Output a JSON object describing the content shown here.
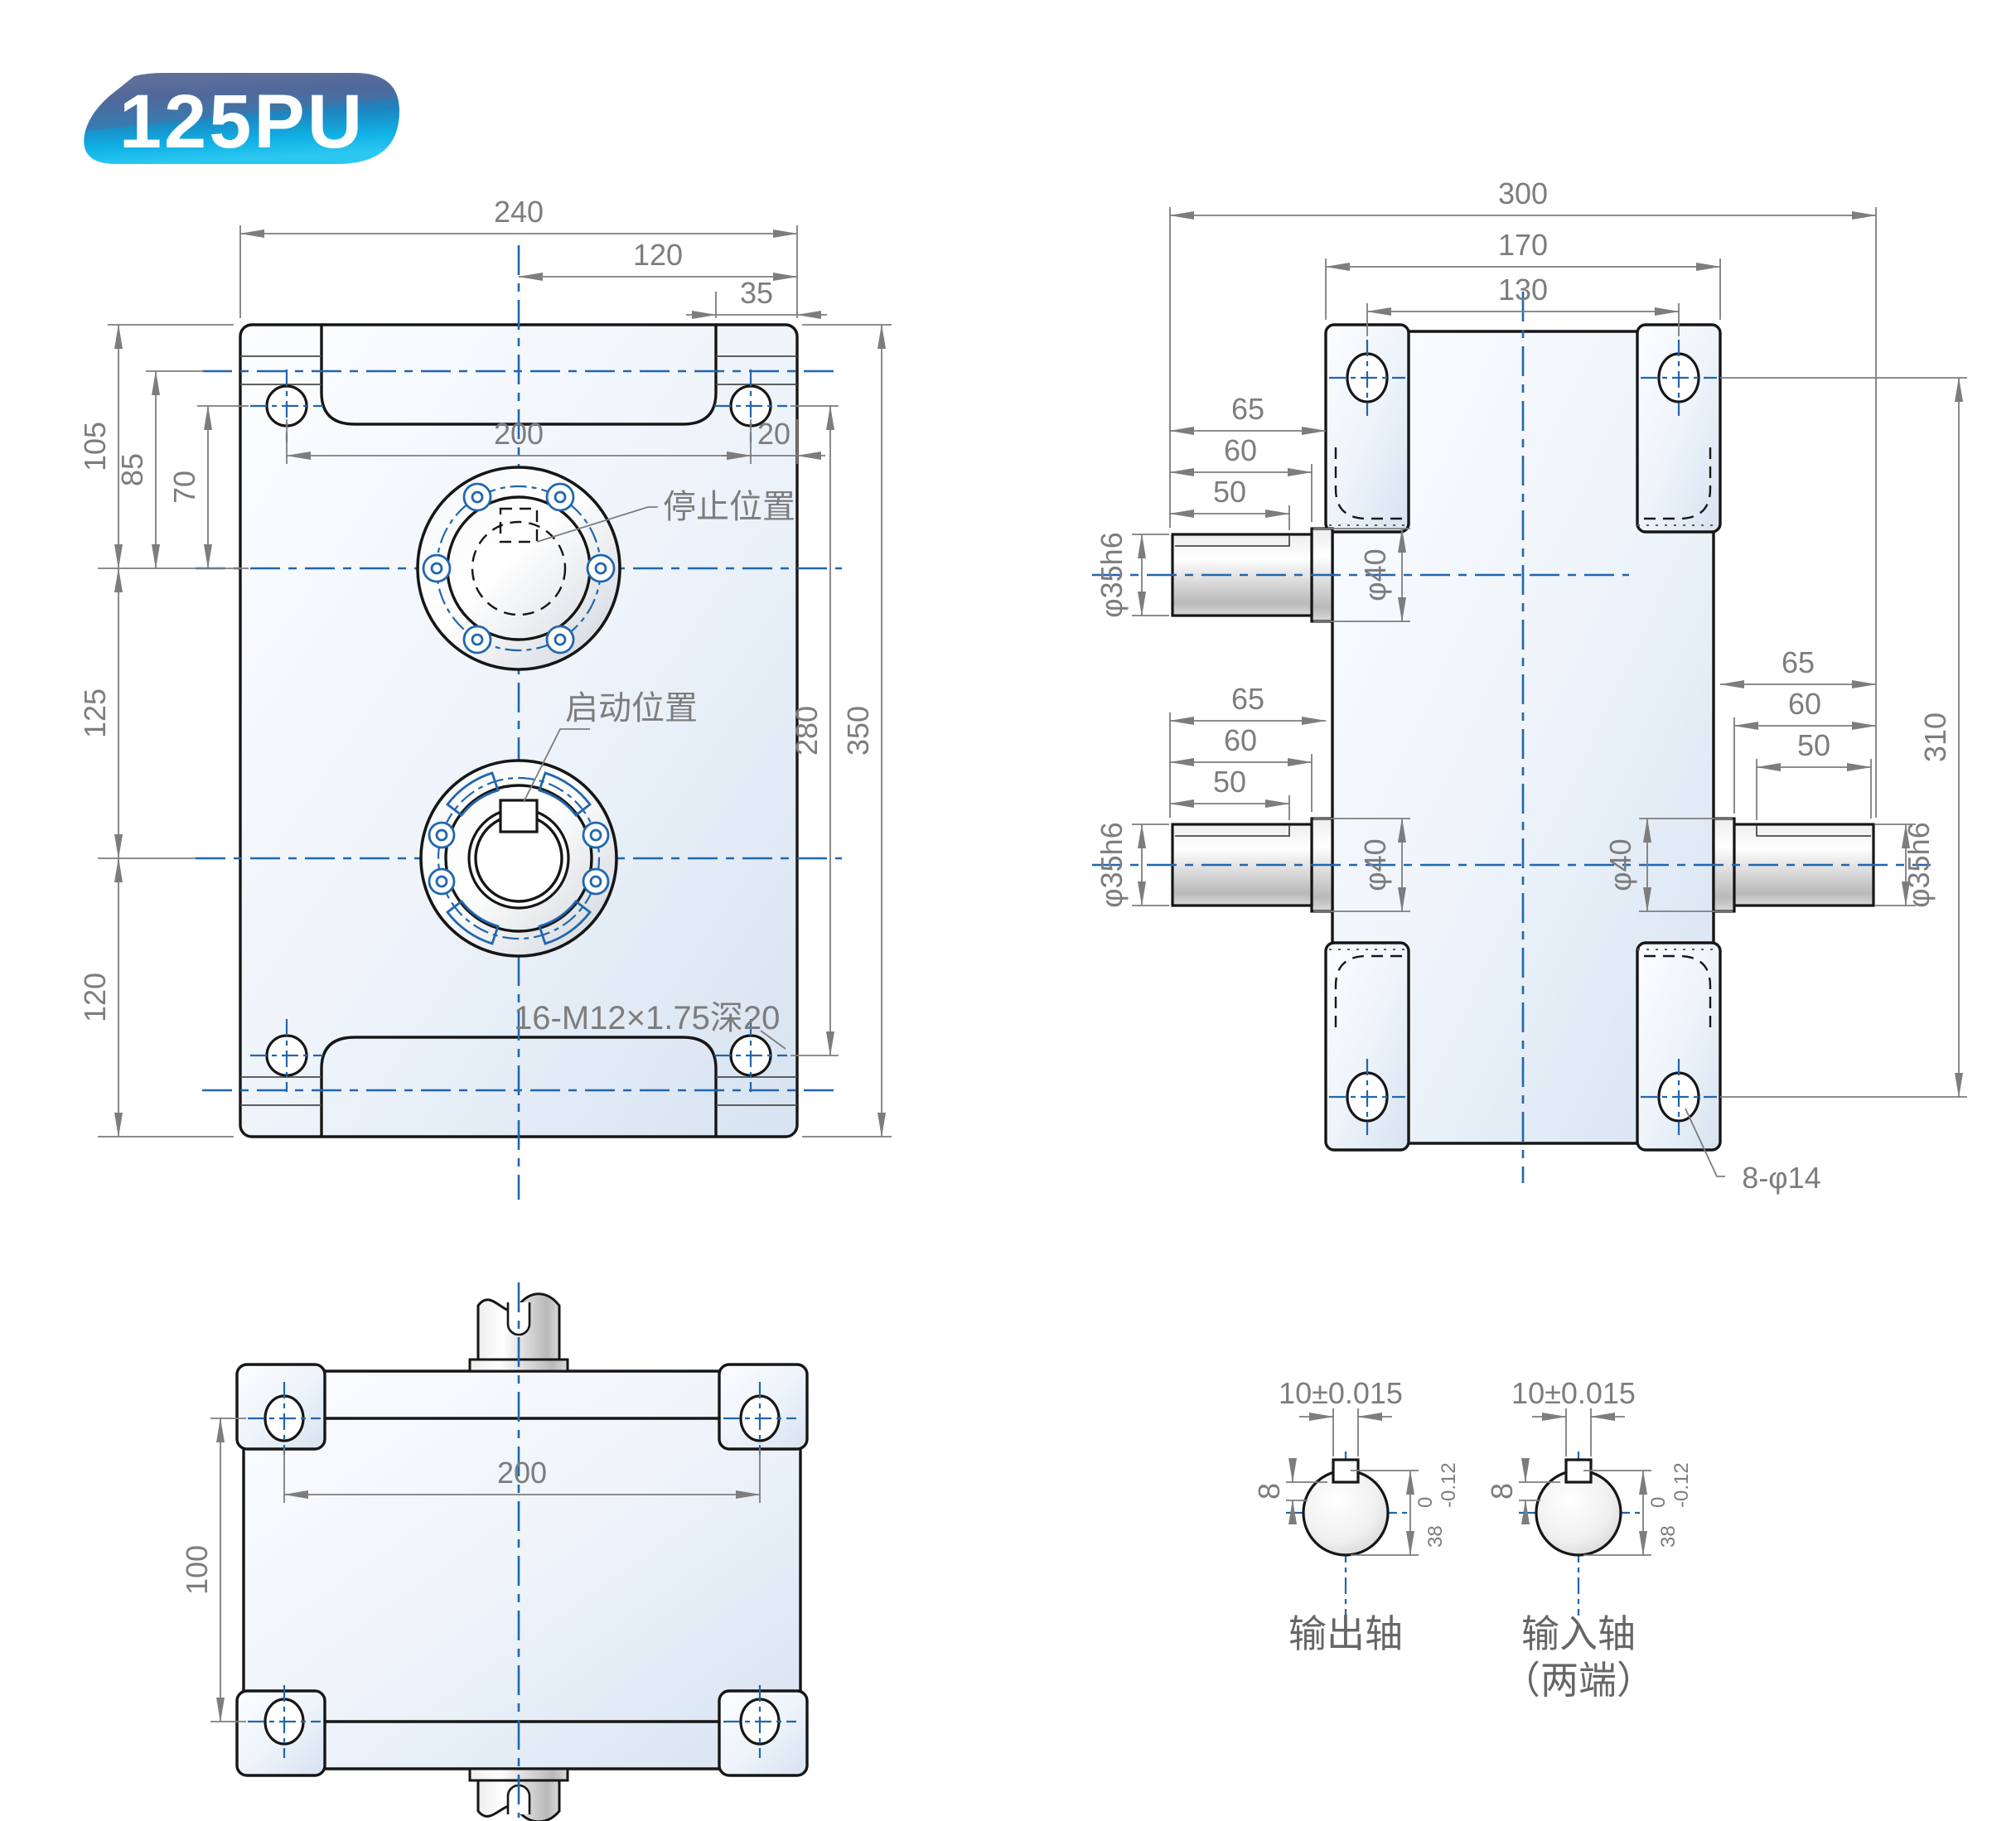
{
  "badge": {
    "label": "125PU"
  },
  "colors": {
    "accent_blue": "#2166ae",
    "dim_gray": "#7d7d7d",
    "outline": "#161616",
    "badge_cyan": "#14b2e6",
    "badge_slate": "#67739b"
  },
  "front_view": {
    "dim_width": "240",
    "dim_half_width": "120",
    "dim_ear": "35",
    "dim_hole_span": "200",
    "dim_edge_offset": "20",
    "dim_105": "105",
    "dim_85": "85",
    "dim_70": "70",
    "dim_125": "125",
    "dim_120": "120",
    "dim_hole_span_v": "280",
    "dim_height": "350",
    "label_stop": "停止位置",
    "label_start": "启动位置",
    "label_thread": "16-M12×1.75深20"
  },
  "side_view": {
    "dim_total_width": "300",
    "dim_lug_width": "170",
    "dim_hole_span": "130",
    "dim_shaft_len": "65",
    "dim_boss_len": "60",
    "dim_key_len": "50",
    "dim_shaft_dia": "φ35h6",
    "dim_bore_dia": "φ40",
    "dim_height": "310",
    "label_holes": "8-φ14"
  },
  "bottom_view": {
    "dim_hole_span": "200",
    "dim_vert": "100"
  },
  "sections": {
    "dim_key_width": "10±0.015",
    "dim_key_depth": "8",
    "dim_dia": "38",
    "dim_tol_upper": "0",
    "dim_tol_lower": "-0.12",
    "label_output": "输出轴",
    "label_input": "输入轴",
    "label_input_note": "（两端）"
  }
}
